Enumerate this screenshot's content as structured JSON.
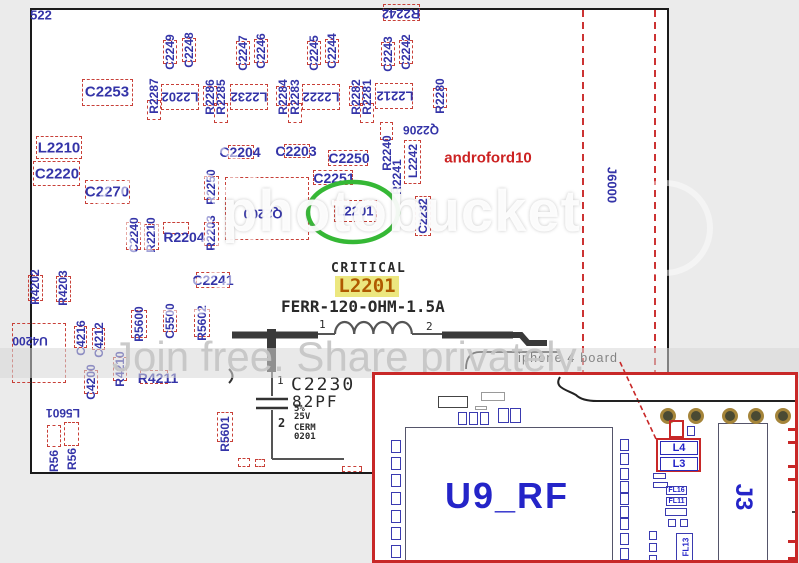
{
  "watermark": {
    "brand": "photobucket",
    "tagline": "Join free. Share privately."
  },
  "critical": {
    "title": "CRITICAL",
    "ref": "L2201",
    "spec": "FERR-120-OHM-1.5A"
  },
  "inductor": {
    "pin1": "1",
    "pin2": "2"
  },
  "capacitor": {
    "ref": "C2230",
    "value": "82PF",
    "tol": "5%",
    "volt": "25V",
    "mat": "CERM",
    "pkg": "0201",
    "pin1": "1",
    "pin2": "2"
  },
  "callout": {
    "board": "iphone 4 board"
  },
  "inset": {
    "u9": "U9_RF",
    "j3": "J3",
    "l4": "L4",
    "l3": "L3",
    "fl16": "FL16",
    "fl11": "FL11",
    "fl13": "FL13",
    "deco": {
      "left_col_y": [
        65,
        82,
        99,
        117,
        135,
        152,
        170
      ],
      "right_col_y": [
        64,
        78,
        93,
        106,
        118,
        131,
        143,
        158,
        173
      ],
      "vias_x": [
        285,
        313,
        347,
        373,
        400
      ],
      "small_boxes": [
        [
          63,
          21,
          30,
          12,
          "d"
        ],
        [
          106,
          17,
          24,
          9,
          "g"
        ],
        [
          100,
          31,
          12,
          4,
          "g"
        ],
        [
          83,
          37,
          9,
          13,
          "b"
        ],
        [
          94,
          37,
          9,
          13,
          "b"
        ],
        [
          105,
          37,
          9,
          13,
          "b"
        ],
        [
          123,
          33,
          11,
          15,
          "b"
        ],
        [
          135,
          33,
          11,
          15,
          "b"
        ],
        [
          294,
          45,
          15,
          18,
          "r"
        ],
        [
          312,
          51,
          8,
          10,
          "b"
        ],
        [
          278,
          98,
          13,
          6,
          "b"
        ],
        [
          278,
          107,
          15,
          6,
          "b"
        ],
        [
          290,
          133,
          22,
          8,
          "b"
        ],
        [
          293,
          144,
          8,
          8,
          "b"
        ],
        [
          305,
          144,
          8,
          8,
          "b"
        ],
        [
          274,
          156,
          8,
          9,
          "b"
        ],
        [
          274,
          168,
          8,
          9,
          "b"
        ],
        [
          274,
          180,
          8,
          9,
          "b"
        ],
        [
          413,
          53,
          10,
          16,
          "rb"
        ],
        [
          413,
          90,
          10,
          16,
          "rb"
        ],
        [
          415,
          74,
          8,
          3,
          "rf"
        ],
        [
          417,
          136,
          8,
          2,
          "d"
        ],
        [
          413,
          165,
          10,
          20,
          "rb"
        ],
        [
          5,
          29,
          2,
          28,
          "df"
        ],
        [
          355,
          45,
          26,
          4,
          "rf"
        ],
        [
          382,
          48,
          6,
          2,
          "rf"
        ]
      ]
    }
  },
  "colors": {
    "label_blue": "#3434a8",
    "box_red": "#c84038",
    "accent_red": "#cc2222",
    "green": "#35b835",
    "highlight_bg": "#ece77f",
    "highlight_text": "#b05a00",
    "inset_blue": "#2424c8",
    "via_gold": "#a5853a"
  },
  "board": {
    "components": [
      {
        "t": "522",
        "x": 41,
        "y": 15,
        "r": 0,
        "fs": 13
      },
      {
        "t": "C2253",
        "x": 107,
        "y": 92,
        "r": 0,
        "fs": 15
      },
      {
        "t": "C2249",
        "x": 170,
        "y": 52,
        "r": -90,
        "fs": 12
      },
      {
        "t": "C2248",
        "x": 189,
        "y": 50,
        "r": -90,
        "fs": 12
      },
      {
        "t": "R2287",
        "x": 154,
        "y": 96,
        "r": -90,
        "fs": 12
      },
      {
        "t": "L2202",
        "x": 180,
        "y": 97,
        "r": 180,
        "fs": 13
      },
      {
        "t": "R2286",
        "x": 210,
        "y": 97,
        "r": -90,
        "fs": 12
      },
      {
        "t": "R2285",
        "x": 221,
        "y": 97,
        "r": -90,
        "fs": 12
      },
      {
        "t": "L2232",
        "x": 249,
        "y": 97,
        "r": 180,
        "fs": 13
      },
      {
        "t": "C2247",
        "x": 243,
        "y": 53,
        "r": -90,
        "fs": 12
      },
      {
        "t": "C2246",
        "x": 261,
        "y": 51,
        "r": -90,
        "fs": 12
      },
      {
        "t": "C2245",
        "x": 314,
        "y": 53,
        "r": -90,
        "fs": 12
      },
      {
        "t": "C2244",
        "x": 332,
        "y": 51,
        "r": -90,
        "fs": 12
      },
      {
        "t": "R2284",
        "x": 283,
        "y": 97,
        "r": -90,
        "fs": 12
      },
      {
        "t": "R2283",
        "x": 295,
        "y": 97,
        "r": -90,
        "fs": 12
      },
      {
        "t": "L2222",
        "x": 321,
        "y": 97,
        "r": 180,
        "fs": 13
      },
      {
        "t": "R2282",
        "x": 356,
        "y": 97,
        "r": -90,
        "fs": 12
      },
      {
        "t": "R2281",
        "x": 367,
        "y": 97,
        "r": -90,
        "fs": 12
      },
      {
        "t": "L2212",
        "x": 395,
        "y": 96,
        "r": 180,
        "fs": 13
      },
      {
        "t": "C2243",
        "x": 388,
        "y": 54,
        "r": -90,
        "fs": 12
      },
      {
        "t": "C2242",
        "x": 406,
        "y": 52,
        "r": -90,
        "fs": 12
      },
      {
        "t": "R2280",
        "x": 440,
        "y": 96,
        "r": -90,
        "fs": 12
      },
      {
        "t": "R2242",
        "x": 401,
        "y": 14,
        "r": 180,
        "fs": 13
      },
      {
        "t": "Q2206",
        "x": 421,
        "y": 130,
        "r": 180,
        "fs": 12
      },
      {
        "t": "C2204",
        "x": 240,
        "y": 152,
        "r": 0,
        "fs": 14
      },
      {
        "t": "C2203",
        "x": 296,
        "y": 151,
        "r": 0,
        "fs": 14
      },
      {
        "t": "C2250",
        "x": 349,
        "y": 158,
        "r": 0,
        "fs": 14
      },
      {
        "t": "C2251",
        "x": 334,
        "y": 178,
        "r": 0,
        "fs": 14
      },
      {
        "t": "L2242",
        "x": 413,
        "y": 161,
        "r": -90,
        "fs": 12
      },
      {
        "t": "R2240",
        "x": 387,
        "y": 153,
        "r": -90,
        "fs": 12
      },
      {
        "t": "R2241",
        "x": 397,
        "y": 177,
        "r": -90,
        "fs": 12
      },
      {
        "t": "C2232",
        "x": 423,
        "y": 216,
        "r": -90,
        "fs": 12
      },
      {
        "t": "androford10",
        "x": 488,
        "y": 158,
        "r": 0,
        "fs": 15,
        "c": "#cc2222"
      },
      {
        "t": "L2210",
        "x": 59,
        "y": 148,
        "r": 0,
        "fs": 15
      },
      {
        "t": "C2220",
        "x": 57,
        "y": 174,
        "r": 0,
        "fs": 15
      },
      {
        "t": "C2270",
        "x": 107,
        "y": 192,
        "r": 0,
        "fs": 15
      },
      {
        "t": "Q2200",
        "x": 263,
        "y": 214,
        "r": 180,
        "fs": 13
      },
      {
        "t": "L2201",
        "x": 355,
        "y": 211,
        "r": 0,
        "fs": 13
      },
      {
        "t": "C2240",
        "x": 134,
        "y": 235,
        "r": -90,
        "fs": 12
      },
      {
        "t": "R2210",
        "x": 151,
        "y": 235,
        "r": -90,
        "fs": 12
      },
      {
        "t": "R2204",
        "x": 184,
        "y": 237,
        "r": 0,
        "fs": 14
      },
      {
        "t": "R2250",
        "x": 211,
        "y": 187,
        "r": -90,
        "fs": 12
      },
      {
        "t": "R2203",
        "x": 211,
        "y": 233,
        "r": -90,
        "fs": 12
      },
      {
        "t": "C2241",
        "x": 213,
        "y": 280,
        "r": 0,
        "fs": 14
      },
      {
        "t": "R4202",
        "x": 35,
        "y": 287,
        "r": -90,
        "fs": 12
      },
      {
        "t": "R4203",
        "x": 63,
        "y": 288,
        "r": -90,
        "fs": 12
      },
      {
        "t": "U4200",
        "x": 30,
        "y": 341,
        "r": 180,
        "fs": 12
      },
      {
        "t": "C4216",
        "x": 81,
        "y": 338,
        "r": -90,
        "fs": 12
      },
      {
        "t": "C4212",
        "x": 99,
        "y": 340,
        "r": -90,
        "fs": 12
      },
      {
        "t": "C4200",
        "x": 91,
        "y": 382,
        "r": -90,
        "fs": 12
      },
      {
        "t": "R4210",
        "x": 120,
        "y": 369,
        "r": -90,
        "fs": 12
      },
      {
        "t": "R5600",
        "x": 139,
        "y": 324,
        "r": -90,
        "fs": 12
      },
      {
        "t": "C5500",
        "x": 170,
        "y": 321,
        "r": -90,
        "fs": 12
      },
      {
        "t": "R5602",
        "x": 202,
        "y": 323,
        "r": -90,
        "fs": 12
      },
      {
        "t": "R4211",
        "x": 158,
        "y": 378,
        "r": 0,
        "fs": 14
      },
      {
        "t": "R5601",
        "x": 225,
        "y": 434,
        "r": -90,
        "fs": 12
      },
      {
        "t": "L5601",
        "x": 63,
        "y": 413,
        "r": 180,
        "fs": 12
      },
      {
        "t": "R56",
        "x": 54,
        "y": 461,
        "r": -90,
        "fs": 12
      },
      {
        "t": "R56",
        "x": 72,
        "y": 459,
        "r": -90,
        "fs": 12
      },
      {
        "t": "J6000",
        "x": 612,
        "y": 185,
        "r": 90,
        "fs": 13
      }
    ],
    "boxes": [
      [
        82,
        79,
        51,
        27
      ],
      [
        161,
        84,
        38,
        26
      ],
      [
        230,
        84,
        38,
        26
      ],
      [
        302,
        84,
        38,
        26
      ],
      [
        375,
        83,
        38,
        26
      ],
      [
        383,
        4,
        37,
        17
      ],
      [
        36,
        136,
        46,
        23
      ],
      [
        33,
        161,
        47,
        25
      ],
      [
        85,
        180,
        45,
        24
      ],
      [
        225,
        177,
        84,
        63
      ],
      [
        334,
        200,
        43,
        22
      ],
      [
        328,
        150,
        40,
        16
      ],
      [
        313,
        170,
        40,
        15
      ],
      [
        404,
        140,
        17,
        44
      ],
      [
        415,
        196,
        16,
        40
      ],
      [
        228,
        145,
        26,
        14
      ],
      [
        284,
        144,
        26,
        14
      ],
      [
        163,
        222,
        26,
        12
      ],
      [
        196,
        272,
        34,
        16
      ],
      [
        12,
        323,
        54,
        60
      ],
      [
        163,
        40,
        14,
        24
      ],
      [
        182,
        38,
        14,
        24
      ],
      [
        236,
        41,
        14,
        24
      ],
      [
        254,
        39,
        14,
        24
      ],
      [
        307,
        41,
        14,
        24
      ],
      [
        325,
        39,
        14,
        24
      ],
      [
        381,
        42,
        14,
        24
      ],
      [
        399,
        40,
        14,
        24
      ],
      [
        147,
        100,
        14,
        20
      ],
      [
        203,
        86,
        14,
        20
      ],
      [
        214,
        103,
        14,
        20
      ],
      [
        276,
        86,
        14,
        20
      ],
      [
        288,
        103,
        14,
        20
      ],
      [
        349,
        86,
        14,
        20
      ],
      [
        360,
        103,
        14,
        20
      ],
      [
        433,
        88,
        14,
        20
      ],
      [
        126,
        222,
        15,
        28
      ],
      [
        144,
        224,
        15,
        26
      ],
      [
        204,
        176,
        15,
        24
      ],
      [
        204,
        222,
        15,
        24
      ],
      [
        28,
        275,
        15,
        26
      ],
      [
        56,
        276,
        15,
        26
      ],
      [
        131,
        310,
        16,
        28
      ],
      [
        163,
        310,
        14,
        22
      ],
      [
        194,
        309,
        16,
        28
      ],
      [
        113,
        357,
        14,
        24
      ],
      [
        84,
        370,
        14,
        24
      ],
      [
        74,
        326,
        13,
        22
      ],
      [
        92,
        328,
        13,
        22
      ],
      [
        140,
        370,
        28,
        14
      ],
      [
        217,
        412,
        16,
        30
      ],
      [
        47,
        425,
        14,
        22
      ],
      [
        64,
        422,
        15,
        24
      ],
      [
        380,
        122,
        13,
        18
      ],
      [
        238,
        458,
        12,
        9
      ],
      [
        255,
        459,
        10,
        8
      ],
      [
        342,
        466,
        20,
        6
      ]
    ]
  }
}
